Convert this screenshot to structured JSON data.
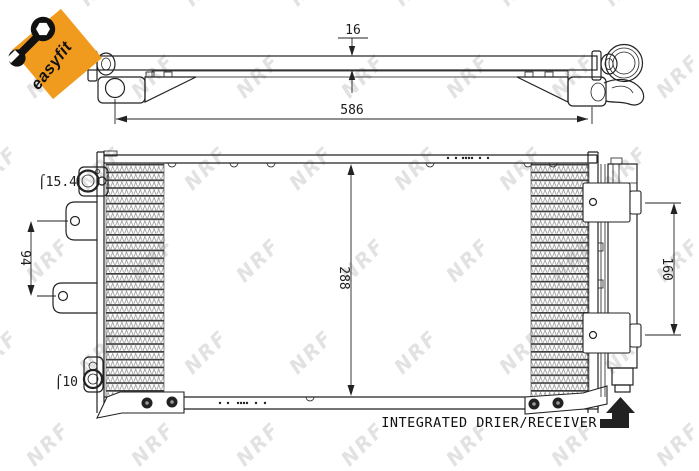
{
  "badge": {
    "label": "easyfit",
    "color": "#F19B1E"
  },
  "watermark": {
    "text": "NRF"
  },
  "top_view": {
    "thickness_label": "16",
    "width_label": "586"
  },
  "front_view": {
    "height_label": "288",
    "left_bracket_pitch_label": "94",
    "right_bracket_pitch_label": "160",
    "top_port_label": "⌠15.4",
    "bottom_port_label": "⌠10"
  },
  "annotation": {
    "integrated_drier": "INTEGRATED DRIER/RECEIVER"
  },
  "colors": {
    "accent_orange": "#F19B1E",
    "line": "#222222",
    "watermark_gray": "#cbcbcb"
  }
}
